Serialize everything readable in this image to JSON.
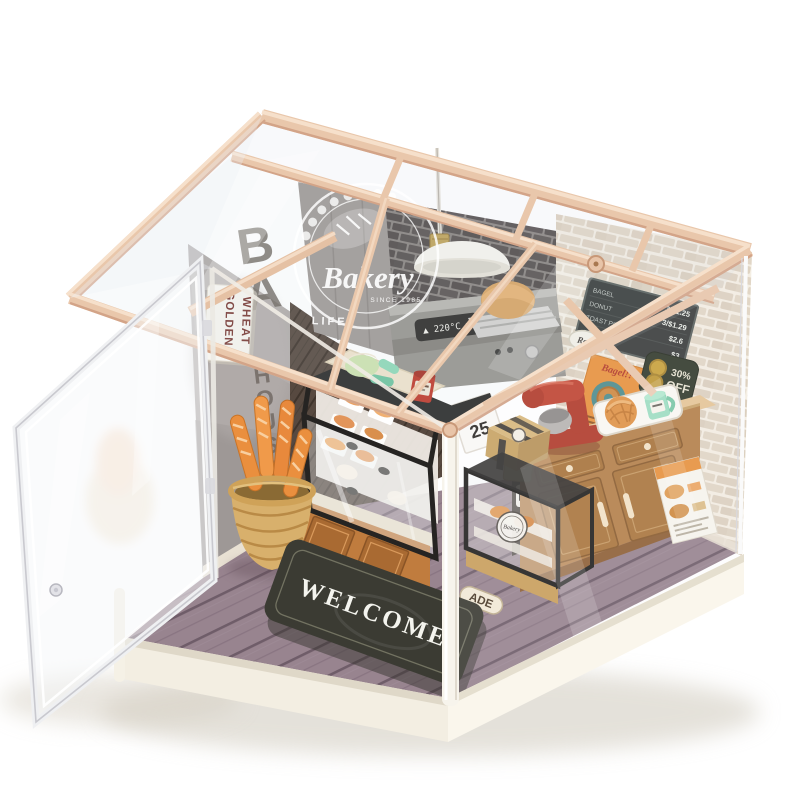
{
  "meta": {
    "subject": "DIY miniature bakery shop kit displayed in a clear acrylic box with pink wooden greenhouse roof and open acrylic door"
  },
  "signs": {
    "window_decal_title": "Bakery",
    "window_decal_since": "SINCE 1985",
    "window_decal_life": "LIFE",
    "wall_letters_top": "BA",
    "wall_letters_bottom": "HOUSE",
    "lightbox_line1": "GOLDEN",
    "lightbox_line2": "WHEAT",
    "oven_display": "▲ 220°C ▼",
    "calendar_day": "25",
    "ribbon_left": "SWEET",
    "ribbon_right": "ADE",
    "welcome_mat": "WELCOME",
    "discount_line1": "30%",
    "discount_line2": "OFF",
    "poster_title": "Bagel!!",
    "roll_sign": "Roll",
    "case_sticker": "Bakery"
  },
  "menu_board": {
    "rows": [
      {
        "item": "BAGEL",
        "price": "3/$1.25"
      },
      {
        "item": "DONUT",
        "price": "3/$1.29"
      },
      {
        "item": "TOAST PIE",
        "price": "$2.6"
      },
      {
        "item": "CROISSANT",
        "price": "$3"
      }
    ]
  },
  "colors": {
    "roof_wood": "#ecc9ae",
    "base_white": "#f7f3ea",
    "brick_wall": "#efe8dc",
    "concrete_wall": "#a9a3a1",
    "floor_wood": "#97838f",
    "case_wood": "#c07c3e",
    "counter_wood": "#b5804a",
    "mat": "#3b3b33",
    "baguette": "#ea8f3e",
    "mixer_red": "#b23b2b",
    "mug_mint": "#8fd9b8",
    "discount_green": "#333a2c",
    "poster_orange": "#e8923e",
    "sign_text_red": "#7a3a34"
  }
}
